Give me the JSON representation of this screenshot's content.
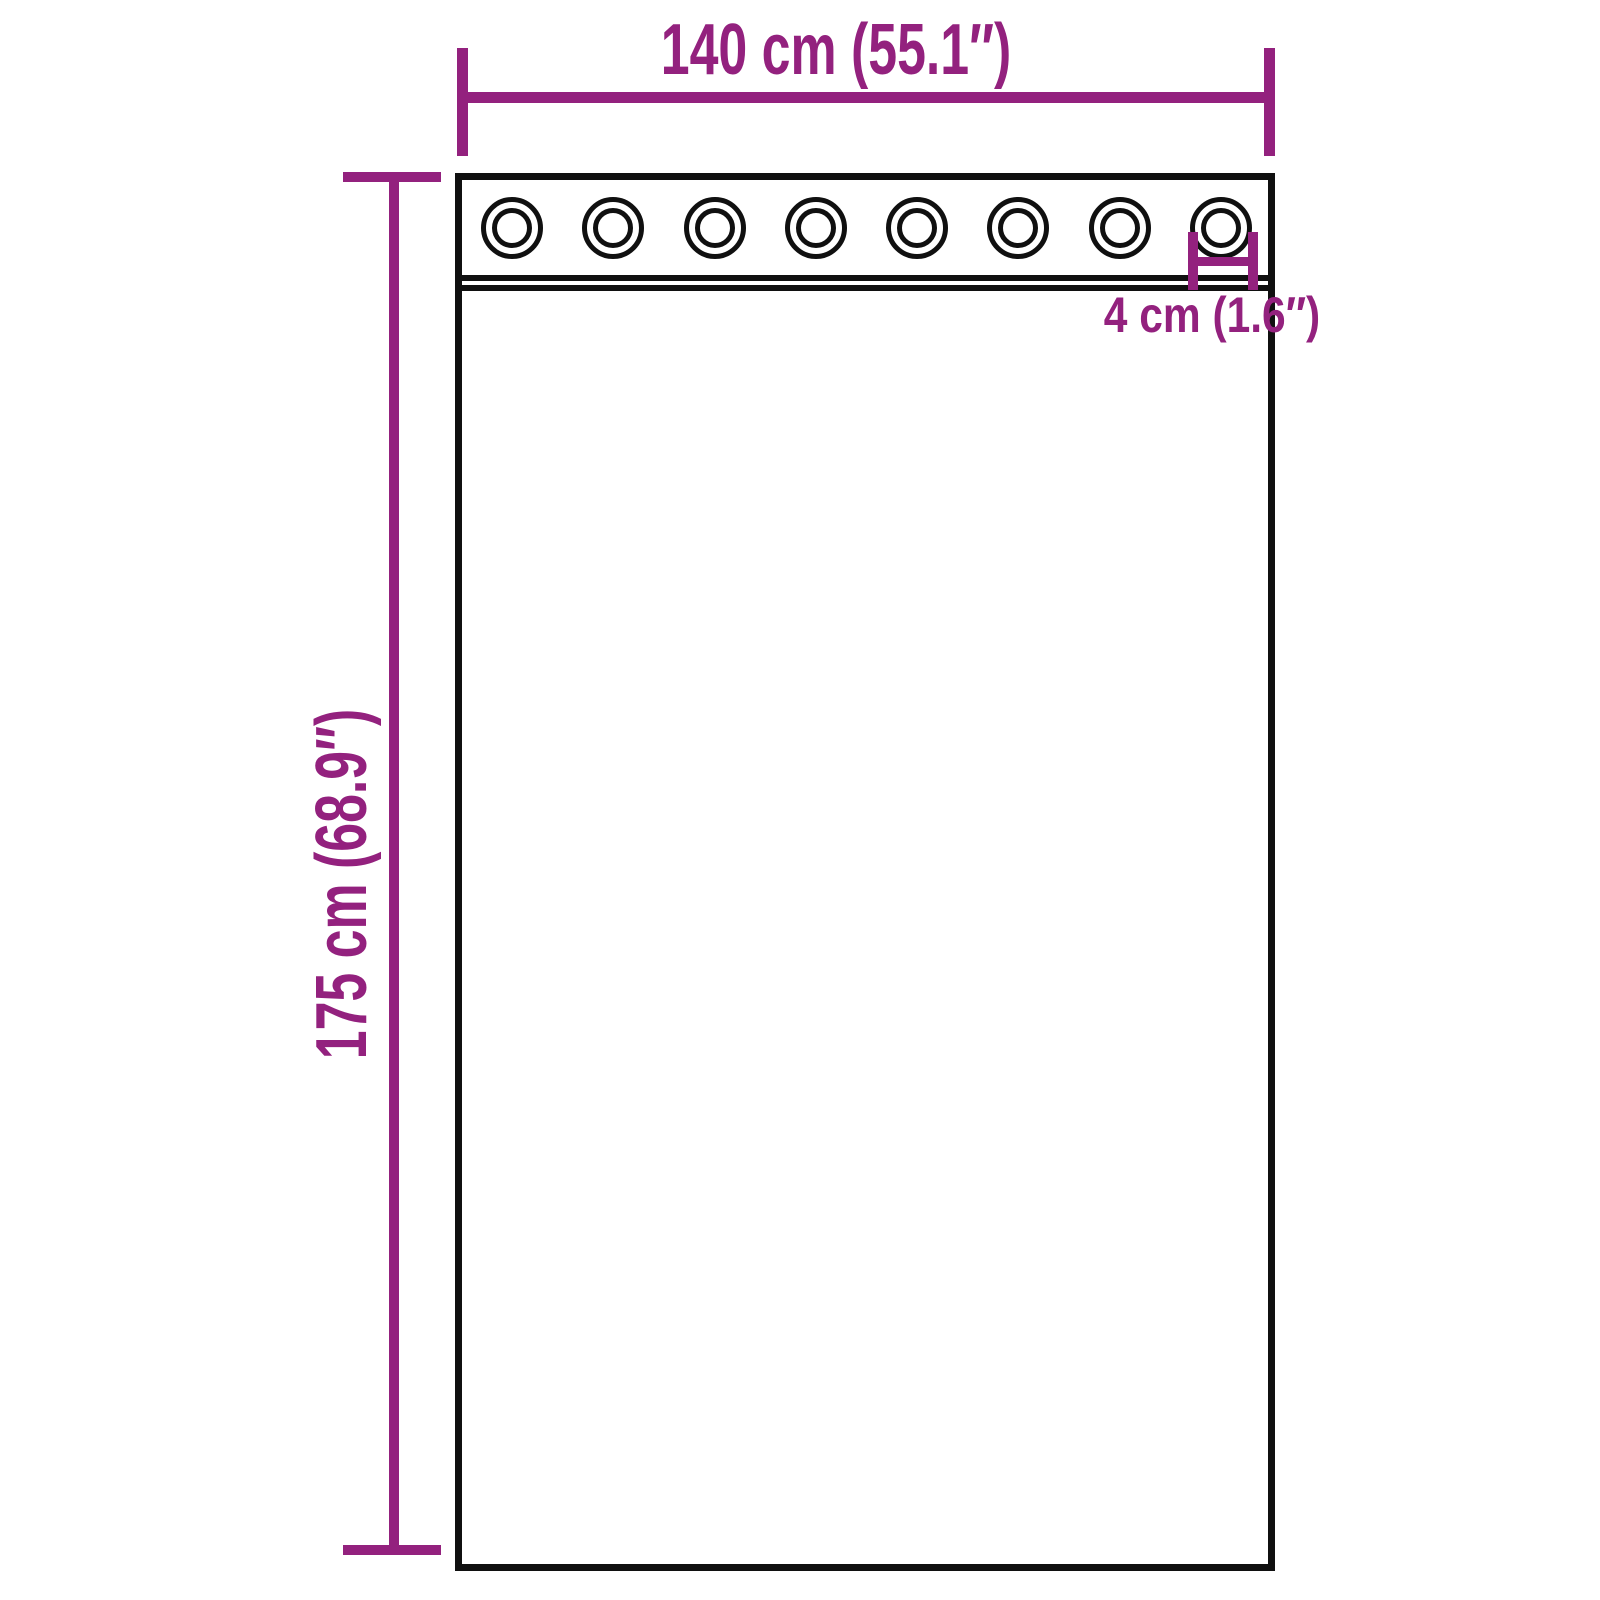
{
  "diagram": {
    "type": "product-dimension-diagram",
    "subject": "curtain panel with grommets",
    "colors": {
      "dimension_accent": "#93217E",
      "outline": "#101010",
      "background": "#FFFFFF"
    },
    "dimensions": {
      "width": {
        "label": "140 cm (55.1″)"
      },
      "height": {
        "label": "175 cm (68.9″)"
      },
      "grommet": {
        "label": "4 cm (1.6″)"
      }
    },
    "curtain": {
      "grommet_count": 8
    }
  }
}
